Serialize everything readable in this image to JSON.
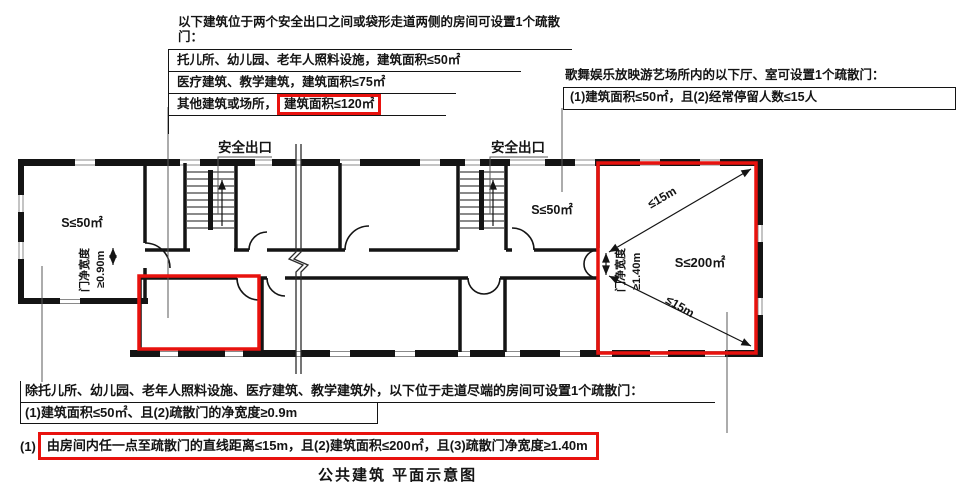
{
  "colors": {
    "highlight_red": "#e8120e",
    "ink": "#141414"
  },
  "blocks": {
    "two_exits": {
      "title": "以下建筑位于两个安全出口之间或袋形走道两侧的房间可设置1个疏散门：",
      "rows": [
        "托儿所、幼儿园、老年人照料设施，建筑面积≤50㎡",
        "医疗建筑、教学建筑，建筑面积≤75㎡"
      ],
      "row3_prefix": "其他建筑或场所，",
      "row3_highlight": "建筑面积≤120㎡"
    },
    "entertainment": {
      "title": "歌舞娱乐放映游艺场所内的以下厅、室可设置1个疏散门：",
      "condition": "(1)建筑面积≤50㎡，且(2)经常停留人数≤15人"
    },
    "corridor_end": {
      "title": "除托儿所、幼儿园、老年人照料设施、医疗建筑、教学建筑外，以下位于走道尽端的房间可设置1个疏散门：",
      "condition": "(1)建筑面积≤50㎡、且(2)疏散门的净宽度≥0.9m"
    },
    "any_point": {
      "prefix": "(1)",
      "highlight": "由房间内任一点至疏散门的直线距离≤15m，且(2)建筑面积≤200㎡，且(3)疏散门净宽度≥1.40m"
    }
  },
  "plan": {
    "exit_label_left": "安全出口",
    "exit_label_right": "安全出口",
    "left_room_area": "S≤50㎡",
    "left_room_door_width_line1": "门净宽度",
    "left_room_door_width_line2": "≥0.90m",
    "mid_room_area": "S≤50㎡",
    "big_room_area": "S≤200㎡",
    "big_room_door_width_line1": "门净宽度",
    "big_room_door_width_line2": "≥1.40m",
    "diagonal_distance_top": "≤15m",
    "diagonal_distance_bottom": "≤15m"
  },
  "caption": "公共建筑 平面示意图"
}
